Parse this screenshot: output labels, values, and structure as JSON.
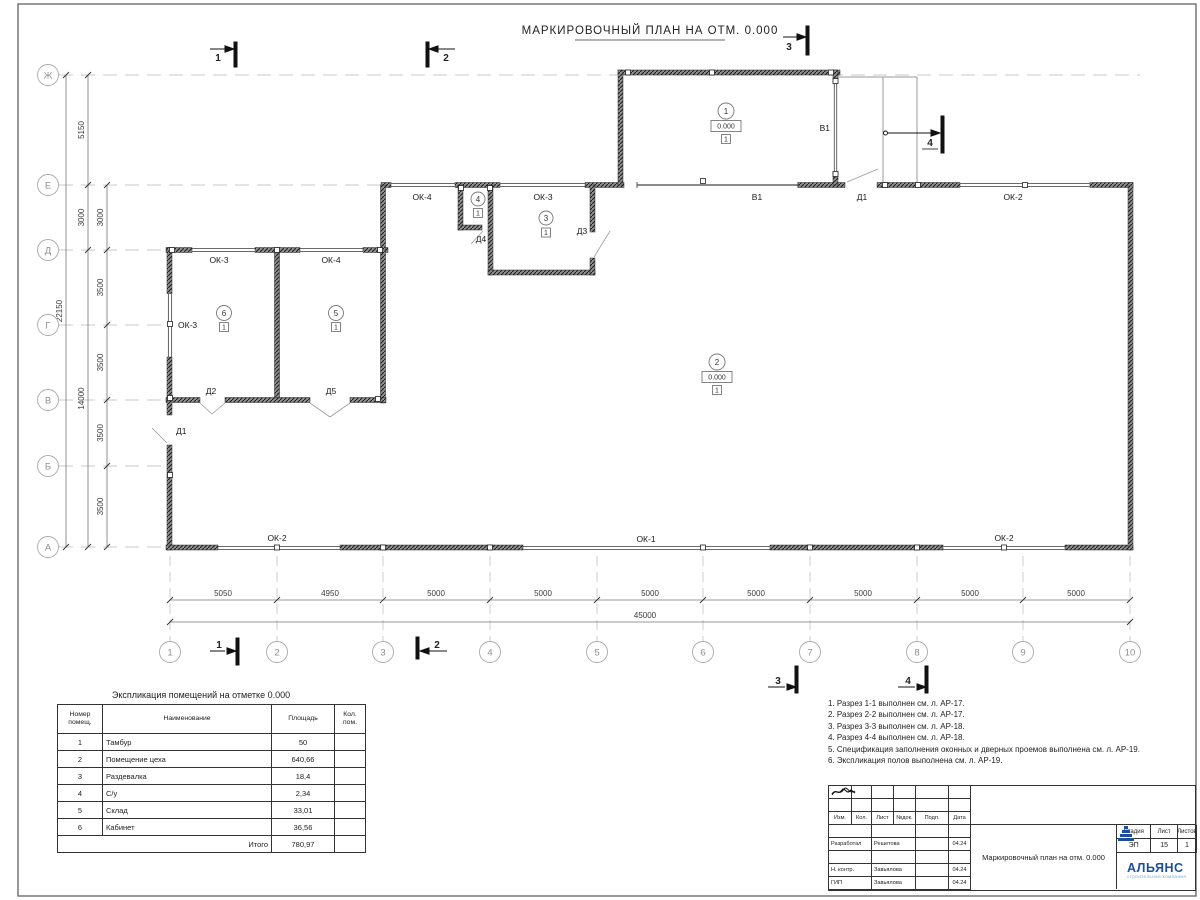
{
  "title": "МАРКИРОВОЧНЫЙ ПЛАН НА ОТМ. 0.000",
  "axes": {
    "rows": [
      "Ж",
      "Е",
      "Д",
      "Г",
      "В",
      "Б",
      "А"
    ],
    "cols": [
      "1",
      "2",
      "3",
      "4",
      "5",
      "6",
      "7",
      "8",
      "9",
      "10"
    ]
  },
  "dims": {
    "left_inner": [
      "3000",
      "3500",
      "3500",
      "3500",
      "3500"
    ],
    "left_mid": [
      "5150",
      "3000",
      "14000"
    ],
    "left_total": "22150",
    "bottom": [
      "5050",
      "4950",
      "5000",
      "5000",
      "5000",
      "5000",
      "5000",
      "5000",
      "5000"
    ],
    "bottom_total": "45000"
  },
  "sections": {
    "s1": "1",
    "s2": "2",
    "s3": "3",
    "s4": "4"
  },
  "labels": {
    "ok1": "ОК-1",
    "ok2": "ОК-2",
    "ok3": "ОК-3",
    "ok4": "ОК-4",
    "d1": "Д1",
    "d2": "Д2",
    "d3": "Д3",
    "d4": "Д4",
    "d5": "Д5",
    "v1": "В1"
  },
  "room_marks": {
    "r1": {
      "num": "1",
      "elev": "0.000",
      "floor": "1"
    },
    "r2": {
      "num": "2",
      "elev": "0.000",
      "floor": "1"
    },
    "r3": {
      "num": "3",
      "floor": "1"
    },
    "r4": {
      "num": "4",
      "floor": "1"
    },
    "r5": {
      "num": "5",
      "floor": "1"
    },
    "r6": {
      "num": "6",
      "floor": "1"
    }
  },
  "schedule": {
    "title": "Экспликация помещений на отметке 0.000",
    "headers": [
      "Номер помещ.",
      "Наименование",
      "Площадь",
      "Кол. пом."
    ],
    "rows": [
      {
        "num": "1",
        "name": "Тамбур",
        "area": "50"
      },
      {
        "num": "2",
        "name": "Помещение цеха",
        "area": "640,66"
      },
      {
        "num": "3",
        "name": "Раздевалка",
        "area": "18,4"
      },
      {
        "num": "4",
        "name": "С/у",
        "area": "2,34"
      },
      {
        "num": "5",
        "name": "Склад",
        "area": "33,01"
      },
      {
        "num": "6",
        "name": "Кабинет",
        "area": "36,56"
      }
    ],
    "total_label": "Итого",
    "total": "780,97"
  },
  "notes": [
    "1. Разрез 1-1 выполнен см. л. АР-17.",
    "2. Разрез 2-2 выполнен см. л. АР-17.",
    "3. Разрез 3-3 выполнен см. л. АР-18.",
    "4. Разрез 4-4 выполнен см. л. АР-18.",
    "5. Спецификация заполнения оконных и дверных проемов выполнена см. л. АР-19.",
    "6. Экспликация полов выполнена см. л. АР-19."
  ],
  "titleblock": {
    "header": [
      "Изм.",
      "Кол.",
      "Лист",
      "№док.",
      "Подп.",
      "Дата"
    ],
    "rows": [
      {
        "role": "Разработал",
        "name": "Решетова",
        "date": "04.24"
      },
      {
        "role": "Н. контр.",
        "name": "Завьялова",
        "date": "04.24"
      },
      {
        "role": "ГИП",
        "name": "Завьялова",
        "date": "04.24"
      }
    ],
    "doc_title": "Маркировочный план на отм. 0.000",
    "stage_label": "Стадия",
    "sheet_label": "Лист",
    "sheets_label": "Листов",
    "stage": "ЭП",
    "sheet": "15",
    "sheets": "1",
    "company": "АЛЬЯНС",
    "company_sub": "строительная компания"
  },
  "colors": {
    "brand_blue": "#1c4e9d",
    "brand_light": "#7aa9d8"
  }
}
